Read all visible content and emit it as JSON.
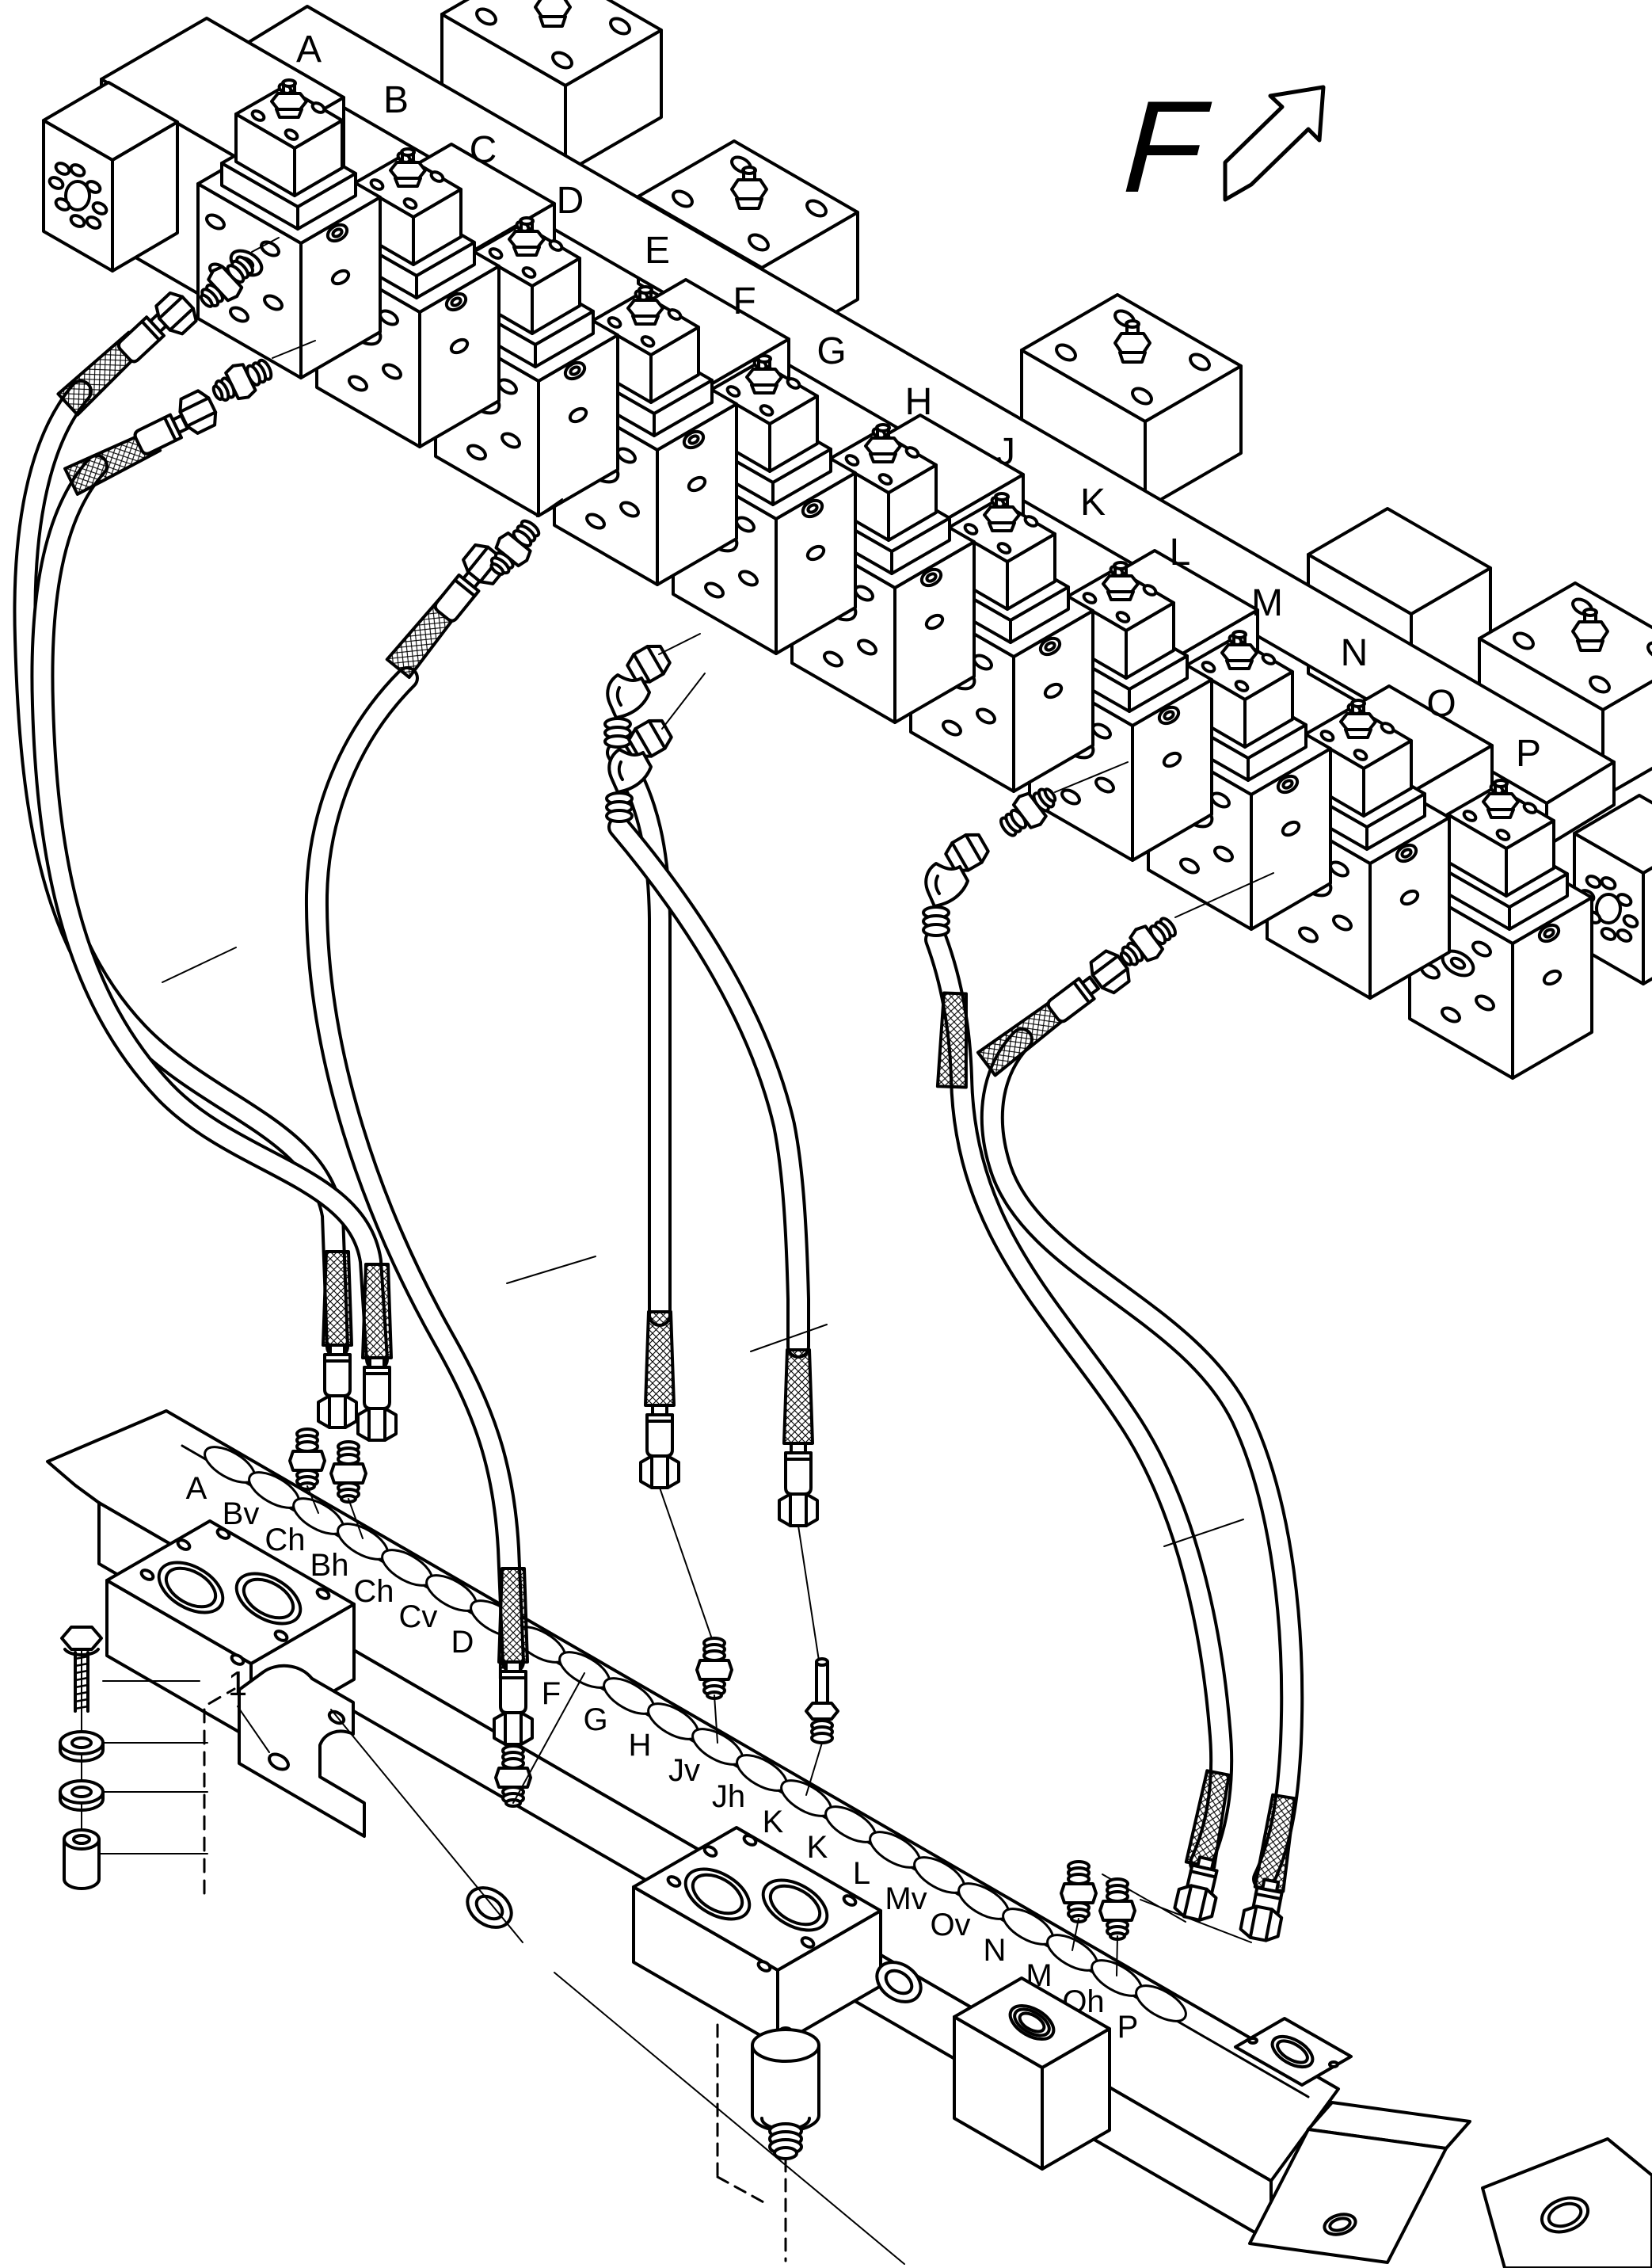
{
  "figure": {
    "type": "exploded-parts-line-diagram",
    "view": {
      "label": "F"
    },
    "item_callout": "1",
    "top_rail": {
      "labels": [
        "A",
        "B",
        "C",
        "D",
        "E",
        "F",
        "G",
        "H",
        "J",
        "K",
        "L",
        "M",
        "N",
        "O",
        "P"
      ]
    },
    "bottom_rail": {
      "labels": [
        "A",
        "Bv",
        "Ch",
        "Bh",
        "Ch",
        "Cv",
        "D",
        "E",
        "F",
        "G",
        "H",
        "Jv",
        "Jh",
        "K",
        "K",
        "L",
        "Mv",
        "Ov",
        "N",
        "M",
        "Oh",
        "P"
      ]
    },
    "colors": {
      "line": "#000000",
      "background": "#ffffff"
    }
  }
}
